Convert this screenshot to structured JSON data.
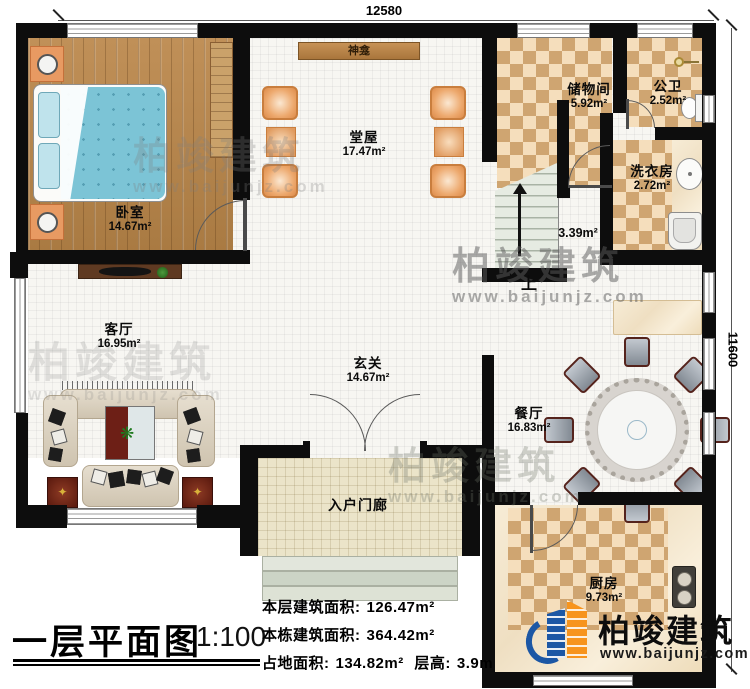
{
  "plan": {
    "dimensions": {
      "width_mm": "12580",
      "height_mm": "11600"
    },
    "rooms": [
      {
        "name": "卧室",
        "area": "14.67m²"
      },
      {
        "name": "堂屋",
        "area": "17.47m²"
      },
      {
        "name": "储物间",
        "area": "5.92m²"
      },
      {
        "name": "公卫",
        "area": "2.52m²"
      },
      {
        "name": "洗衣房",
        "area": "2.72m²"
      },
      {
        "name": "客厅",
        "area": "16.95m²"
      },
      {
        "name": "玄关",
        "area": "14.67m²"
      },
      {
        "name": "餐厅",
        "area": "16.83m²"
      },
      {
        "name": "厨房",
        "area": "9.73m²"
      },
      {
        "name": "入户门廊",
        "area": ""
      }
    ],
    "stair_area": "3.39m²",
    "stair_up": "上",
    "shrine": "神龛"
  },
  "title_block": {
    "title": "一层平面图",
    "scale": "1:100",
    "stats": [
      {
        "label": "本层建筑面积:",
        "value": "126.47m²"
      },
      {
        "label": "本栋建筑面积:",
        "value": "364.42m²"
      },
      {
        "label": "占地面积:",
        "value": "134.82m²",
        "label2": "层高:",
        "value2": "3.9m"
      }
    ]
  },
  "branding": {
    "company": "柏竣建筑",
    "website": "www.baijunjz.com"
  },
  "watermark": {
    "company": "柏竣建筑",
    "website": "www.baijunjz.com"
  },
  "colors": {
    "wall": "#0d0d0d",
    "checker_dark": "#cfa571",
    "checker_light": "#f5debc",
    "wood": "#b5854f",
    "logo_blue": "#1c57a5",
    "logo_orange": "#f7941d"
  }
}
